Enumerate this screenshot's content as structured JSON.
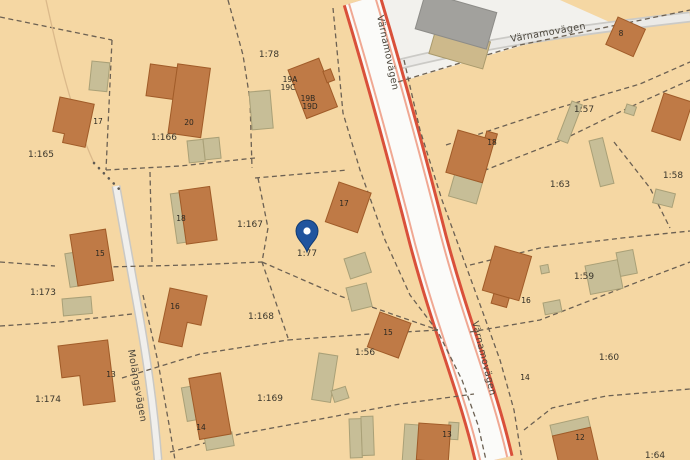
{
  "map": {
    "streets": {
      "main_road_label_top": "Värnamovägen",
      "main_road_label_bottom": "Värnamovägen",
      "branch_road_label": "Värnamovägen",
      "side_street_label": "Molängsvägen"
    },
    "marker": {
      "at_parcel": "1:77"
    },
    "parcels": [
      "1:165",
      "1:78",
      "1:166",
      "1:57",
      "1:58",
      "1:63",
      "1:167",
      "1:77",
      "1:173",
      "1:168",
      "1:56",
      "1:59",
      "1:169",
      "1:174",
      "1:60",
      "1:64"
    ],
    "houses": [
      "17",
      "20",
      "19A",
      "19C",
      "19B",
      "19D",
      "18",
      "17",
      "15",
      "16",
      "13",
      "14",
      "15",
      "13",
      "18",
      "8",
      "16",
      "14",
      "12"
    ],
    "colors": {
      "land": "#f5d7a3",
      "road_red": "#d9503a",
      "road_salmon": "#f0a893",
      "building_orange": "#bf7a46",
      "outbuilding_khaki": "#c7be97",
      "gray_building": "#a2a19d",
      "pin_blue": "#20549e"
    }
  }
}
